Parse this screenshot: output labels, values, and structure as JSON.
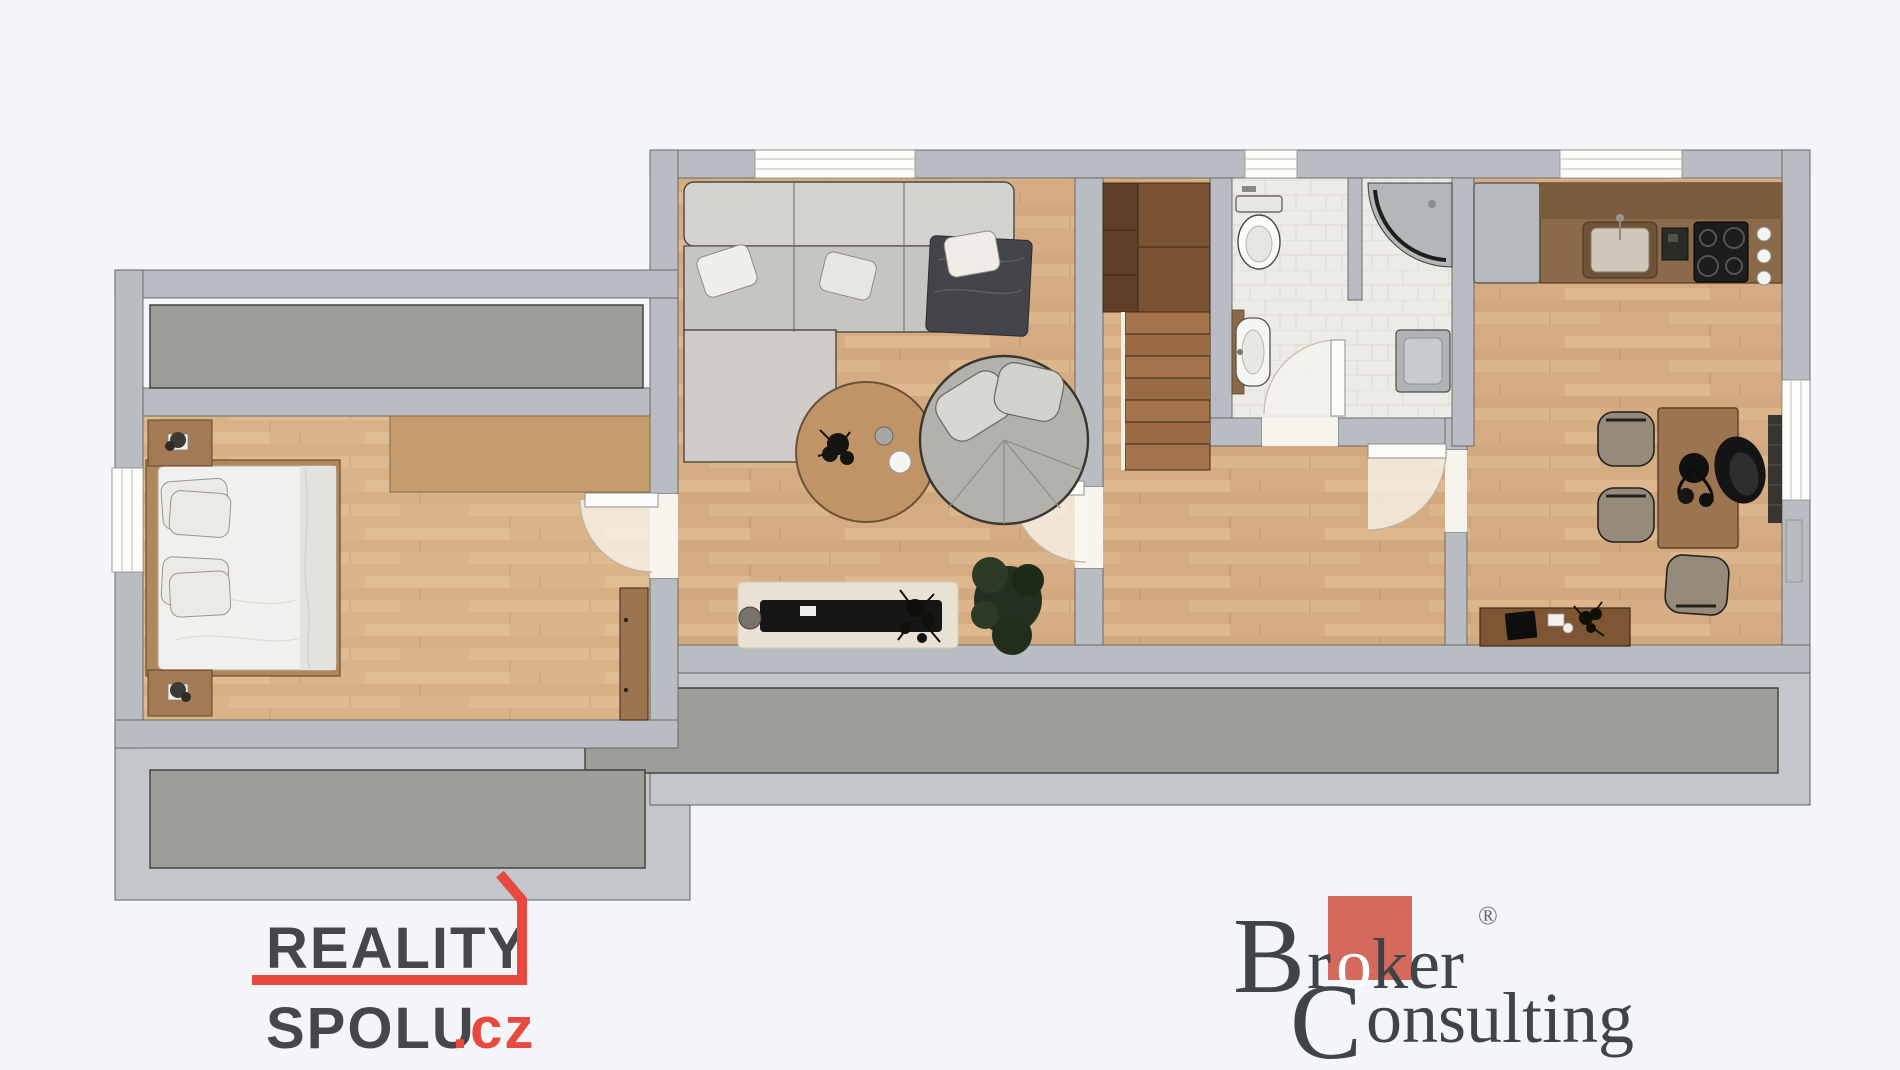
{
  "logos": {
    "reality_spolu": {
      "line1": "REALITY",
      "line2": "SPOLU",
      "suffix": ".cz",
      "text_color": "#45474b",
      "accent_color": "#e8493f"
    },
    "broker_consulting": {
      "b": "B",
      "r": "r",
      "o": "o",
      "k": "k",
      "er": "er",
      "registered": "®",
      "c": "C",
      "onsulting": "onsulting",
      "text_color": "#3f4449",
      "accent_color": "#d4695e"
    }
  },
  "palette": {
    "background": "#f3f5f9",
    "wall": "#b9bdc3",
    "wall_outline": "#5c5c55",
    "terrace": "#9d9d99",
    "wood_floor": "#d8b288",
    "bath_tile": "#edebe7",
    "stairs_dark": "#5e4026",
    "stairs_step": "#a5734c"
  },
  "floor_plan": {
    "type": "apartment-top-view-render",
    "rooms": [
      "bedroom",
      "living-room",
      "hallway",
      "bathroom",
      "shower-room",
      "kitchen-dining",
      "staircase",
      "loggia-storage",
      "terrace"
    ],
    "furniture": [
      "double-bed",
      "nightstand",
      "corner-sofa",
      "coffee-table",
      "swivel-lounge-chair",
      "tv-bench",
      "rug",
      "plants",
      "toilet",
      "washbasin",
      "corner-shower",
      "washing-machine",
      "fridge",
      "kitchen-counter",
      "kitchen-sink",
      "cooktop",
      "dining-table",
      "dining-chairs",
      "desk-chair",
      "sideboard"
    ],
    "windows": 5,
    "door_arcs": 4
  }
}
